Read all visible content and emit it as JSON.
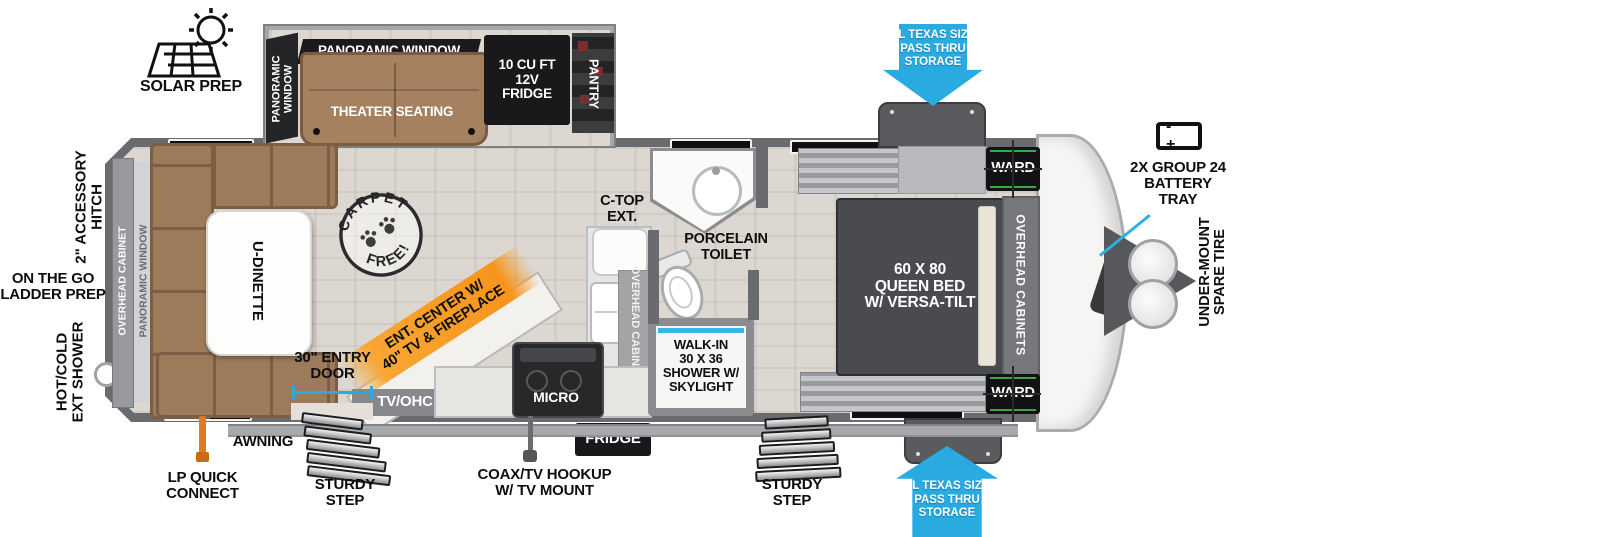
{
  "colors": {
    "arrow_blue": "#29abe2",
    "ribbon_orange": "#f7941d",
    "sofa_brown": "#a5815f",
    "wall_gray": "#6a6b6e",
    "floor_wood": "#dcd8d1",
    "label_black": "#0e0e0e"
  },
  "exterior": {
    "solar_prep": "SOLAR PREP",
    "accessory_hitch": "2\" ACCESSORY\nHITCH",
    "ladder_prep": "ON THE GO\nLADDER PREP",
    "ext_shower": "HOT/COLD\nEXT SHOWER",
    "lp_quick_connect": "LP QUICK\nCONNECT",
    "awning": "AWNING",
    "sturdy_step_door": "STURDY\nSTEP",
    "sturdy_step_bed": "STURDY\nSTEP",
    "coax_hookup": "COAX/TV HOOKUP\nW/ TV MOUNT",
    "battery_tray": "2X GROUP 24\nBATTERY\nTRAY",
    "battery_terminals": "-  +",
    "spare_tire": "UNDER-MOUNT\nSPARE TIRE",
    "pass_thru_top": "XL TEXAS SIZE\nPASS THRU\nSTORAGE",
    "pass_thru_bottom": "XL TEXAS SIZE\nPASS THRU\nSTORAGE"
  },
  "living": {
    "panoramic_window_top": "PANORAMIC WINDOW",
    "panoramic_window_side": "PANORAMIC\nWINDOW",
    "theater_seating": "THEATER SEATING",
    "fridge_12v": "10 CU FT\n12V\nFRIDGE",
    "pantry": "PANTRY",
    "u_dinette": "U-DINETTE",
    "rear_overhead_cabinet": "OVERHEAD CABINET",
    "rear_panoramic_window": "PANORAMIC WINDOW",
    "carpet_free_top": "CARPET",
    "carpet_free_bottom": "FREE!",
    "ent_center": "ENT. CENTER W/\n40\" TV & FIREPLACE",
    "tv_ohc": "TV/OHC",
    "entry_door": "30\" ENTRY\nDOOR"
  },
  "kitchen": {
    "c_top_ext": "C-TOP\nEXT.",
    "overhead_cabinet": "OVERHEAD CABINET",
    "micro": "MICRO",
    "fridge": "FRIDGE"
  },
  "bath": {
    "porcelain_toilet": "PORCELAIN\nTOILET",
    "shower": "WALK-IN\n30 X 36\nSHOWER W/\nSKYLIGHT"
  },
  "bedroom": {
    "queen_bed": "60 X 80\nQUEEN BED\nW/ VERSA-TILT",
    "overhead_cabinets": "OVERHEAD CABINETS",
    "ward_top": "WARD",
    "ward_bottom": "WARD"
  }
}
